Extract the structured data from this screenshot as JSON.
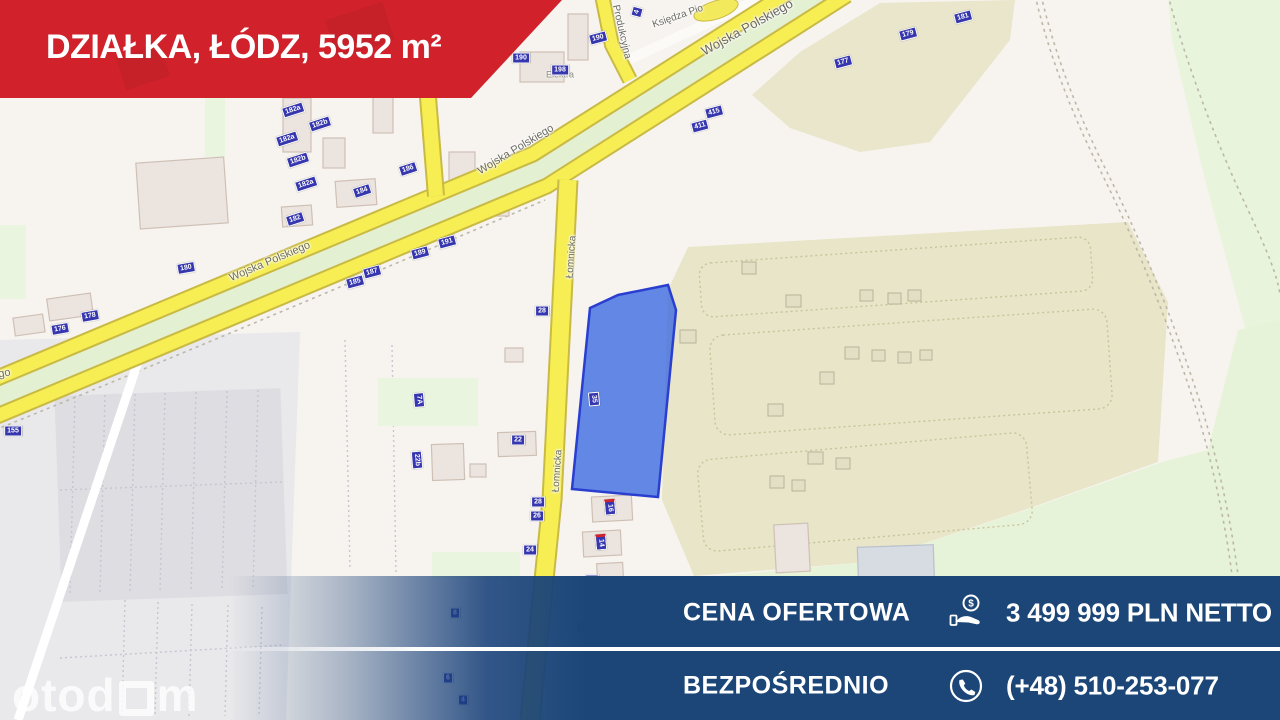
{
  "banner": {
    "title": "DZIAŁKA, ŁÓDZ, 5952 m²",
    "background_color": "#d1222c"
  },
  "offer_bar": {
    "background_color": "#1b4677",
    "rows": [
      {
        "label": "CENA OFERTOWA",
        "icon": "coin-hand-icon",
        "value": "3 499 999 PLN NETTO"
      },
      {
        "label": "BEZPOŚREDNIO",
        "icon": "phone-circle-icon",
        "value": "(+48) 510-253-077"
      }
    ]
  },
  "watermark": {
    "logo_left": "otod",
    "logo_right": "m",
    "brand": "otodom"
  },
  "map": {
    "plot_color": "#3a68e0",
    "road_color": "#f6ee52",
    "marker_color": "#3636ae",
    "street_labels": [
      {
        "text": "Wojska Polskiego",
        "x": 270,
        "y": 262,
        "rot": -23,
        "size": 11
      },
      {
        "text": "Wojska Polskiego",
        "x": -32,
        "y": 381,
        "rot": -11,
        "size": 11
      },
      {
        "text": "Wojska Polskiego",
        "x": 747,
        "y": 27,
        "rot": -29,
        "size": 13
      },
      {
        "text": "Wojska Polskiego",
        "x": 516,
        "y": 150,
        "rot": -31,
        "size": 11
      },
      {
        "text": "Łomnicka",
        "x": 572,
        "y": 257,
        "rot": -86,
        "size": 10
      },
      {
        "text": "Łomnicka",
        "x": 558,
        "y": 471,
        "rot": -86,
        "size": 10
      },
      {
        "text": "Produkcyjna",
        "x": 621,
        "y": 32,
        "rot": 77,
        "size": 10
      },
      {
        "text": "Księdza Pio",
        "x": 678,
        "y": 17,
        "rot": -19,
        "size": 10
      }
    ],
    "poi_labels": [
      {
        "text": "Elektra",
        "x": 560,
        "y": 75
      }
    ],
    "markers": [
      {
        "label": "182a",
        "x": 293,
        "y": 110,
        "rot": -18
      },
      {
        "label": "182b",
        "x": 320,
        "y": 124,
        "rot": -18
      },
      {
        "label": "182a",
        "x": 287,
        "y": 139,
        "rot": -18
      },
      {
        "label": "182b",
        "x": 298,
        "y": 160,
        "rot": -18
      },
      {
        "label": "182a",
        "x": 306,
        "y": 184,
        "rot": -18
      },
      {
        "label": "182",
        "x": 295,
        "y": 219,
        "rot": -18
      },
      {
        "label": "184",
        "x": 362,
        "y": 191,
        "rot": -18
      },
      {
        "label": "186",
        "x": 408,
        "y": 169,
        "rot": -18
      },
      {
        "label": "180",
        "x": 186,
        "y": 268,
        "rot": -10
      },
      {
        "label": "178",
        "x": 90,
        "y": 316,
        "rot": -10
      },
      {
        "label": "176",
        "x": 60,
        "y": 329,
        "rot": -10
      },
      {
        "label": "155",
        "x": 13,
        "y": 431,
        "rot": 0
      },
      {
        "label": "190",
        "x": 598,
        "y": 38,
        "rot": -15
      },
      {
        "label": "190",
        "x": 521,
        "y": 58,
        "rot": 0
      },
      {
        "label": "198",
        "x": 560,
        "y": 70,
        "rot": 0
      },
      {
        "label": "4",
        "x": 637,
        "y": 12,
        "rot": -75
      },
      {
        "label": "415",
        "x": 714,
        "y": 112,
        "rot": -15
      },
      {
        "label": "411",
        "x": 700,
        "y": 126,
        "rot": -15
      },
      {
        "label": "191",
        "x": 447,
        "y": 242,
        "rot": -15
      },
      {
        "label": "189",
        "x": 420,
        "y": 253,
        "rot": -15
      },
      {
        "label": "187",
        "x": 372,
        "y": 272,
        "rot": -15
      },
      {
        "label": "185",
        "x": 355,
        "y": 282,
        "rot": -15
      },
      {
        "label": "177",
        "x": 843,
        "y": 62,
        "rot": -15
      },
      {
        "label": "179",
        "x": 908,
        "y": 34,
        "rot": -15
      },
      {
        "label": "181",
        "x": 963,
        "y": 17,
        "rot": -15
      },
      {
        "label": "28",
        "x": 542,
        "y": 311,
        "rot": 0
      },
      {
        "label": "22",
        "x": 518,
        "y": 440,
        "rot": 0
      },
      {
        "label": "7A",
        "x": 419,
        "y": 400,
        "rot": 85
      },
      {
        "label": "22b",
        "x": 417,
        "y": 460,
        "rot": 85
      },
      {
        "label": "28",
        "x": 538,
        "y": 502,
        "rot": 0
      },
      {
        "label": "26",
        "x": 537,
        "y": 516,
        "rot": 0
      },
      {
        "label": "24",
        "x": 530,
        "y": 550,
        "rot": 0
      },
      {
        "label": "16",
        "x": 610,
        "y": 507,
        "rot": 85,
        "accent": true
      },
      {
        "label": "14",
        "x": 601,
        "y": 542,
        "rot": 85,
        "accent": true
      },
      {
        "label": "35",
        "x": 594,
        "y": 399,
        "rot": 85
      },
      {
        "label": "12",
        "x": 592,
        "y": 580,
        "rot": 0
      },
      {
        "label": "10",
        "x": 583,
        "y": 626,
        "rot": 0
      },
      {
        "label": "8",
        "x": 455,
        "y": 613,
        "rot": 0
      },
      {
        "label": "6",
        "x": 448,
        "y": 678,
        "rot": 0
      },
      {
        "label": "4",
        "x": 463,
        "y": 700,
        "rot": 0
      }
    ]
  }
}
